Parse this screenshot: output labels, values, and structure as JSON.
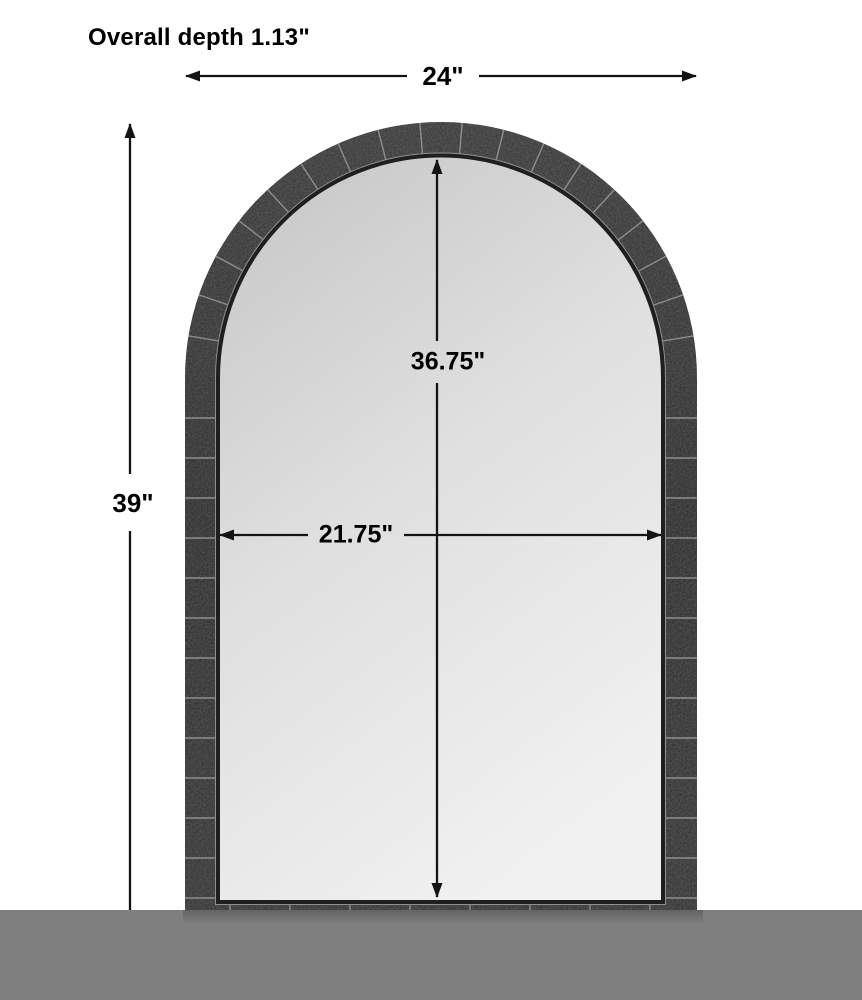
{
  "product_diagram": {
    "overall_depth_label": "Overall depth 1.13\"",
    "overall_width_label": "24\"",
    "overall_height_label": "39\"",
    "glass_height_label": "36.75\"",
    "glass_width_label": "21.75\""
  },
  "colors": {
    "background": "#ffffff",
    "floor": "#7f7f7f",
    "frame": "#2d2d2d",
    "glass": "#e2e2e2",
    "line": "#141414",
    "text": "#000000"
  }
}
